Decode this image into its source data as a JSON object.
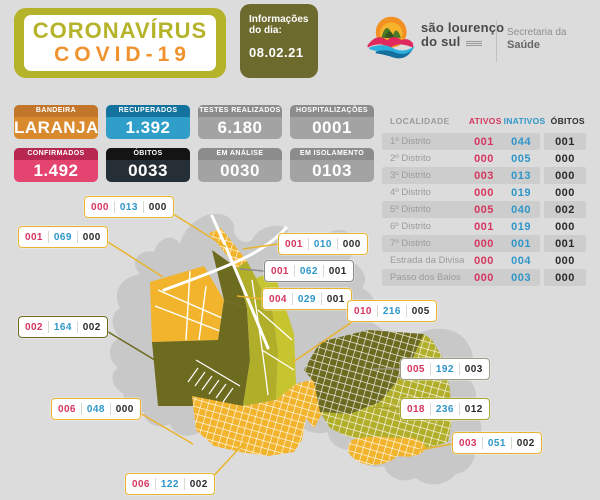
{
  "header": {
    "title_line1": "CORONAVÍRUS",
    "title_line2": "COVID-19",
    "info_label": "Informações do dia:",
    "info_date": "08.02.21",
    "logo_name_line1": "são lourenço",
    "logo_name_line2": "do sul",
    "dept_line1": "Secretaria da",
    "dept_line2": "Saúde"
  },
  "stat_cards": [
    {
      "label": "BANDEIRA",
      "value": "LARANJA",
      "header_color": "#c1762b",
      "body_color": "#d9892e"
    },
    {
      "label": "RECUPERADOS",
      "value": "1.392",
      "header_color": "#14739e",
      "body_color": "#2f9ec8"
    },
    {
      "label": "TESTES REALIZADOS",
      "value": "6.180",
      "header_color": "#8c8c8c",
      "body_color": "#a3a3a3"
    },
    {
      "label": "HOSPITALIZAÇÕES",
      "value": "0001",
      "header_color": "#8c8c8c",
      "body_color": "#a3a3a3"
    },
    {
      "label": "CONFIRMADOS",
      "value": "1.492",
      "header_color": "#b82750",
      "body_color": "#e64470"
    },
    {
      "label": "ÓBITOS",
      "value": "0033",
      "header_color": "#141414",
      "body_color": "#262e36"
    },
    {
      "label": "EM ANÁLISE",
      "value": "0030",
      "header_color": "#8c8c8c",
      "body_color": "#a3a3a3"
    },
    {
      "label": "EM ISOLAMENTO",
      "value": "0103",
      "header_color": "#8c8c8c",
      "body_color": "#a3a3a3"
    }
  ],
  "table": {
    "headers": {
      "localidade": "LOCALIDADE",
      "ativos": "ATIVOS",
      "inativos": "INATIVOS",
      "obitos": "ÓBITOS"
    },
    "rows": [
      {
        "localidade": "1º Distrito",
        "ativos": "001",
        "inativos": "044",
        "obitos": "001"
      },
      {
        "localidade": "2º Distrito",
        "ativos": "000",
        "inativos": "005",
        "obitos": "000"
      },
      {
        "localidade": "3º Distrito",
        "ativos": "003",
        "inativos": "013",
        "obitos": "000"
      },
      {
        "localidade": "4º Distrito",
        "ativos": "000",
        "inativos": "019",
        "obitos": "000"
      },
      {
        "localidade": "5º Distrito",
        "ativos": "005",
        "inativos": "040",
        "obitos": "002"
      },
      {
        "localidade": "6º Distrito",
        "ativos": "001",
        "inativos": "019",
        "obitos": "000"
      },
      {
        "localidade": "7º Distrito",
        "ativos": "000",
        "inativos": "001",
        "obitos": "001"
      },
      {
        "localidade": "Estrada da Divisa",
        "ativos": "000",
        "inativos": "004",
        "obitos": "000"
      },
      {
        "localidade": "Passo dos Baios",
        "ativos": "000",
        "inativos": "003",
        "obitos": "000"
      }
    ]
  },
  "map_labels": [
    {
      "ativos": "000",
      "inativos": "013",
      "obitos": "000",
      "x": 84,
      "y": 196,
      "border": "#e9b42d",
      "line": [
        162,
        207,
        226,
        247
      ]
    },
    {
      "ativos": "001",
      "inativos": "069",
      "obitos": "000",
      "x": 18,
      "y": 226,
      "border": "#e9b42d",
      "line": [
        100,
        237,
        163,
        277
      ]
    },
    {
      "ativos": "002",
      "inativos": "164",
      "obitos": "002",
      "x": 18,
      "y": 316,
      "border": "#6d6a1f",
      "line": [
        100,
        327,
        163,
        365
      ]
    },
    {
      "ativos": "006",
      "inativos": "048",
      "obitos": "000",
      "x": 51,
      "y": 398,
      "border": "#e9b42d",
      "line": [
        133,
        409,
        193,
        444
      ]
    },
    {
      "ativos": "006",
      "inativos": "122",
      "obitos": "002",
      "x": 125,
      "y": 473,
      "border": "#e9b42d",
      "line": [
        207,
        483,
        247,
        440
      ]
    },
    {
      "ativos": "001",
      "inativos": "010",
      "obitos": "000",
      "x": 278,
      "y": 233,
      "border": "#e9b42d",
      "line": [
        278,
        244,
        243,
        249
      ]
    },
    {
      "ativos": "001",
      "inativos": "062",
      "obitos": "001",
      "x": 264,
      "y": 260,
      "border": "#8a8a8a",
      "line": [
        264,
        271,
        240,
        269
      ]
    },
    {
      "ativos": "004",
      "inativos": "029",
      "obitos": "001",
      "x": 262,
      "y": 288,
      "border": "#e9b42d",
      "line": [
        262,
        299,
        237,
        296
      ]
    },
    {
      "ativos": "010",
      "inativos": "216",
      "obitos": "005",
      "x": 347,
      "y": 300,
      "border": "#e9b42d",
      "line": [
        352,
        322,
        293,
        362
      ]
    },
    {
      "ativos": "005",
      "inativos": "192",
      "obitos": "003",
      "x": 400,
      "y": 358,
      "border": "#9c9a80",
      "line": [
        400,
        369,
        373,
        369
      ]
    },
    {
      "ativos": "018",
      "inativos": "236",
      "obitos": "012",
      "x": 400,
      "y": 398,
      "border": "#a8a52e",
      "line": [
        400,
        409,
        373,
        407
      ]
    },
    {
      "ativos": "003",
      "inativos": "051",
      "obitos": "002",
      "x": 452,
      "y": 432,
      "border": "#e9b42d",
      "line": [
        452,
        444,
        414,
        451
      ]
    }
  ],
  "colors": {
    "page_bg": "#dcdcdc",
    "title_green": "#b5b32a",
    "title_orange": "#f0932e",
    "info_olive": "#6d6a2e",
    "map_silhouette": "#c8c8c8",
    "district_yellow": "#f2b42c",
    "district_dark_olive": "#6d6b20",
    "district_yellow_green": "#b1ae29",
    "district_light_green": "#c6c42f",
    "ativos_red": "#d6365f",
    "inativos_blue": "#2e96c8",
    "obitos_dark": "#2b2b2b",
    "table_stripe": "#cdcdcd"
  }
}
